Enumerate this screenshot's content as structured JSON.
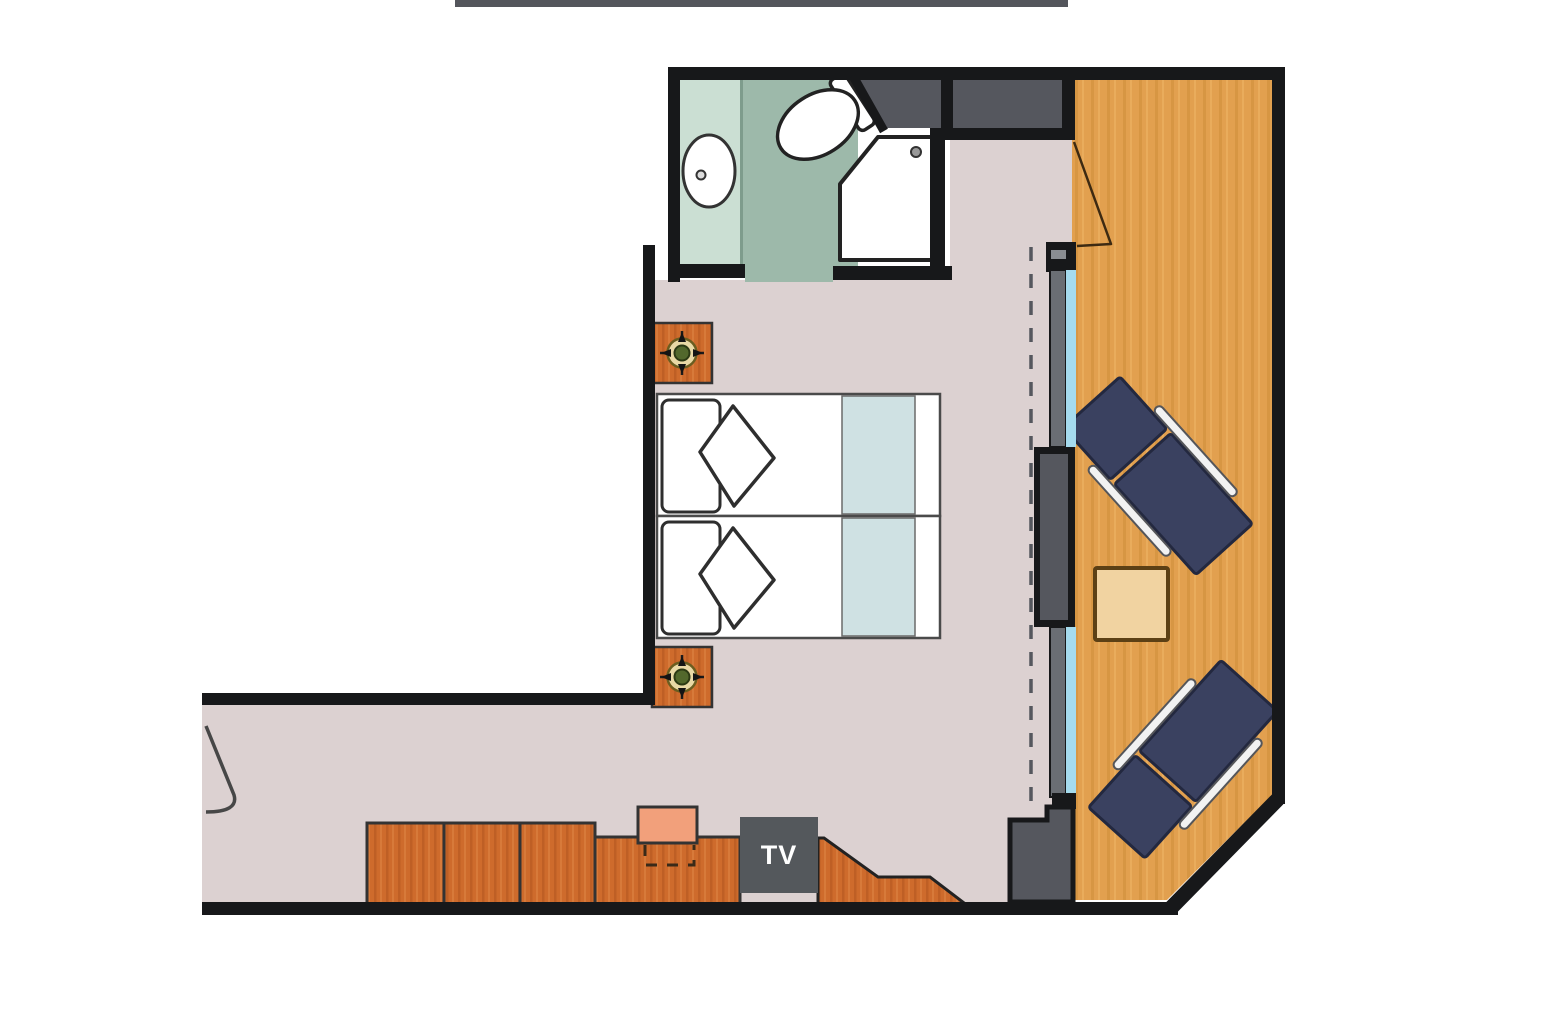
{
  "meta": {
    "type": "floor-plan",
    "description": "Cabin floor plan: bathroom with sink, toilet and shower; bedroom with two twin beds and nightstand lamps; desk run with chair and TV; window wall with sliding balcony door; angled balcony with two sun loungers and a side table"
  },
  "labels": {
    "tv": "TV"
  },
  "colors": {
    "top_bar": "#54565c",
    "wall": "#17181a",
    "floor": "#dcd1d1",
    "wood": "#e2a04f",
    "wood_grain": "#d18f3a",
    "wood_grain_light": "#efb566",
    "bath_light": "#cbdfd3",
    "bath_dark": "#9db9aa",
    "bath_divider": "#7e9c8c",
    "dark_gray": "#55575e",
    "frame_gray": "#6a6e74",
    "glass": "#a5dbee",
    "lounger": "#3a4160",
    "lounger_edge": "#23283f",
    "rail": "#f2f2f2",
    "cabinet": "#ce6b2c",
    "cabinet_grain": "#b85a22",
    "chair": "#f2a07b",
    "table": "#f1d3a1",
    "table_border": "#5c4015",
    "bed_band": "#cfe1e3",
    "tv_box": "#54585c",
    "tv_text": "#ffffff",
    "lamp_ring": "#e9d9a6",
    "lamp_center": "#52682c",
    "sketch": "#2e2e2e"
  },
  "legend": {
    "rooms": [
      "bathroom",
      "bedroom",
      "corridor",
      "balcony",
      "closet"
    ],
    "fixtures": [
      "sink",
      "toilet",
      "shower",
      "twin-bed",
      "twin-bed",
      "nightstand-lamp",
      "nightstand-lamp",
      "cabinet-run",
      "desk",
      "desk-chair",
      "tv-cabinet",
      "sun-lounger",
      "sun-lounger",
      "balcony-table",
      "window-glass",
      "balcony-door-swing",
      "entry-door-swing"
    ]
  }
}
